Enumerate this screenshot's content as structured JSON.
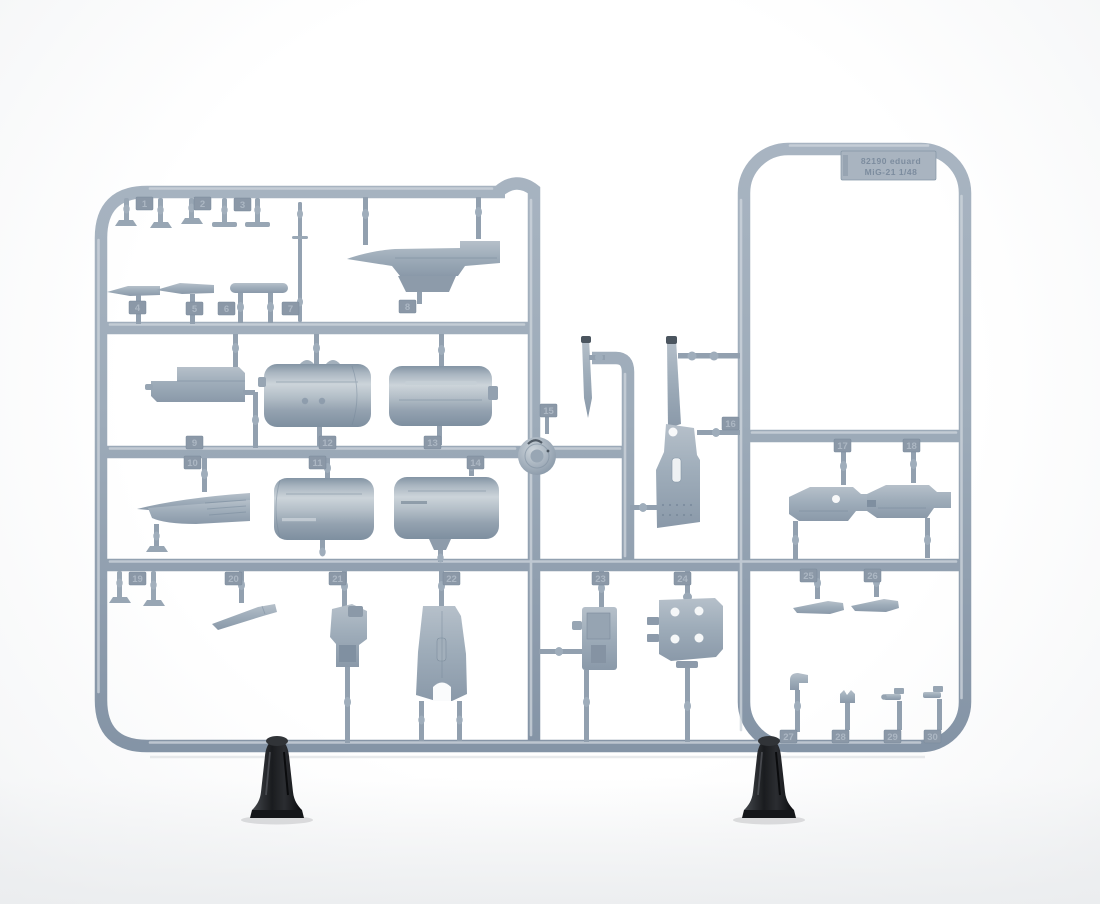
{
  "sprue": {
    "label": {
      "line1": "82190  eduard",
      "line2": "MiG-21  1/48"
    },
    "part_numbers": [
      "1",
      "2",
      "3",
      "4",
      "5",
      "6",
      "7",
      "8",
      "9",
      "10",
      "11",
      "12",
      "13",
      "14",
      "15",
      "16",
      "17",
      "18",
      "19",
      "20",
      "21",
      "22",
      "23",
      "24",
      "25",
      "26",
      "27",
      "28",
      "29",
      "30"
    ]
  },
  "colors": {
    "plastic_mid": "#9aa8b6",
    "plastic_light": "#cbd3da",
    "plastic_dark": "#7b8b9b",
    "tag_fill": "#8b98a7",
    "tag_text": "#b0bbc7",
    "label_text": "#78889b",
    "clamp": "#1b1d21",
    "background": "#fcfcfd"
  }
}
